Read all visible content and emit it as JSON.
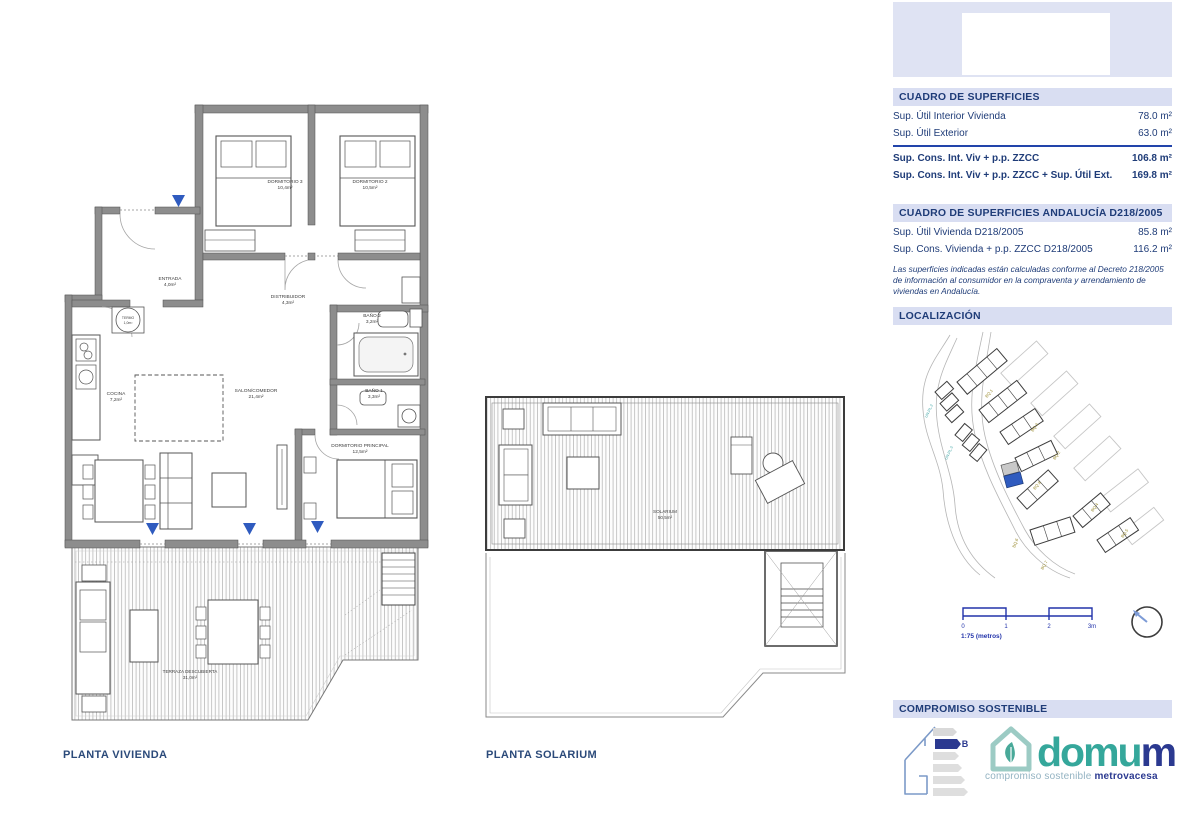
{
  "sidebar": {
    "surfaces": {
      "title": "CUADRO DE SUPERFICIES",
      "rows": [
        {
          "label": "Sup. Útil Interior Vivienda",
          "value": "78.0 m²"
        },
        {
          "label": "Sup. Útil Exterior",
          "value": "63.0 m²"
        }
      ],
      "totals": [
        {
          "label": "Sup. Cons. Int. Viv + p.p. ZZCC",
          "value": "106.8 m²"
        },
        {
          "label": "Sup. Cons. Int. Viv + p.p. ZZCC + Sup. Útil Ext.",
          "value": "169.8 m²"
        }
      ]
    },
    "andalucia": {
      "title": "CUADRO DE SUPERFICIES ANDALUCÍA D218/2005",
      "rows": [
        {
          "label": "Sup. Útil Vivienda D218/2005",
          "value": "85.8 m²"
        },
        {
          "label": "Sup. Cons. Vivienda + p.p. ZZCC D218/2005",
          "value": "116.2 m²"
        }
      ],
      "note": "Las superficies indicadas están calculadas conforme al Decreto 218/2005 de información al consumidor en la compraventa y arrendamiento de viviendas en Andalucía."
    },
    "localizacion": {
      "title": "LOCALIZACIÓN",
      "blocks": [
        "BQ.1",
        "BQ.2",
        "BQ.3",
        "BQ.4",
        "BQ.5",
        "BQ.6",
        "BQ.7",
        "BQ.8"
      ],
      "scale": {
        "t0": "0",
        "t1": "1",
        "t2": "2",
        "t3": "3m",
        "caption": "1:75 (metros)"
      }
    },
    "compromiso": {
      "title": "COMPROMISO SOSTENIBLE",
      "energy_rating": "B",
      "logo_main": "domu",
      "logo_m": "m",
      "logo_sub_plain": "compromiso sostenible ",
      "logo_sub_bold": "metrovacesa"
    }
  },
  "plans": {
    "vivienda": {
      "title": "PLANTA VIVIENDA",
      "rooms": {
        "dormitorio3": {
          "name": "DORMITORIO 3",
          "area": "10,4m²"
        },
        "dormitorio2": {
          "name": "DORMITORIO 2",
          "area": "10,5m²"
        },
        "entrada": {
          "name": "ENTRADA",
          "area": "4,0m²"
        },
        "distribuidor": {
          "name": "DISTRIBUIDOR",
          "area": "4,3m²"
        },
        "termo": {
          "name": "TERMO",
          "area": "1,0m²"
        },
        "bano2": {
          "name": "BAÑO 2",
          "area": "3,2m²"
        },
        "cocina": {
          "name": "COCINA",
          "area": "7,2m²"
        },
        "salon": {
          "name": "SALON/COMEDOR",
          "area": "21,4m²"
        },
        "bano1": {
          "name": "BAÑO 1",
          "area": "3,3m²"
        },
        "principal": {
          "name": "DORMITORIO PRINCIPAL",
          "area": "12,5m²"
        },
        "terraza": {
          "name": "TERRAZA DESCUBIERTA",
          "area": "31,0m²"
        }
      }
    },
    "solarium": {
      "title": "PLANTA SOLARIUM",
      "rooms": {
        "solarium": {
          "name": "SOLARIUM",
          "area": "50,5m²"
        }
      }
    }
  }
}
